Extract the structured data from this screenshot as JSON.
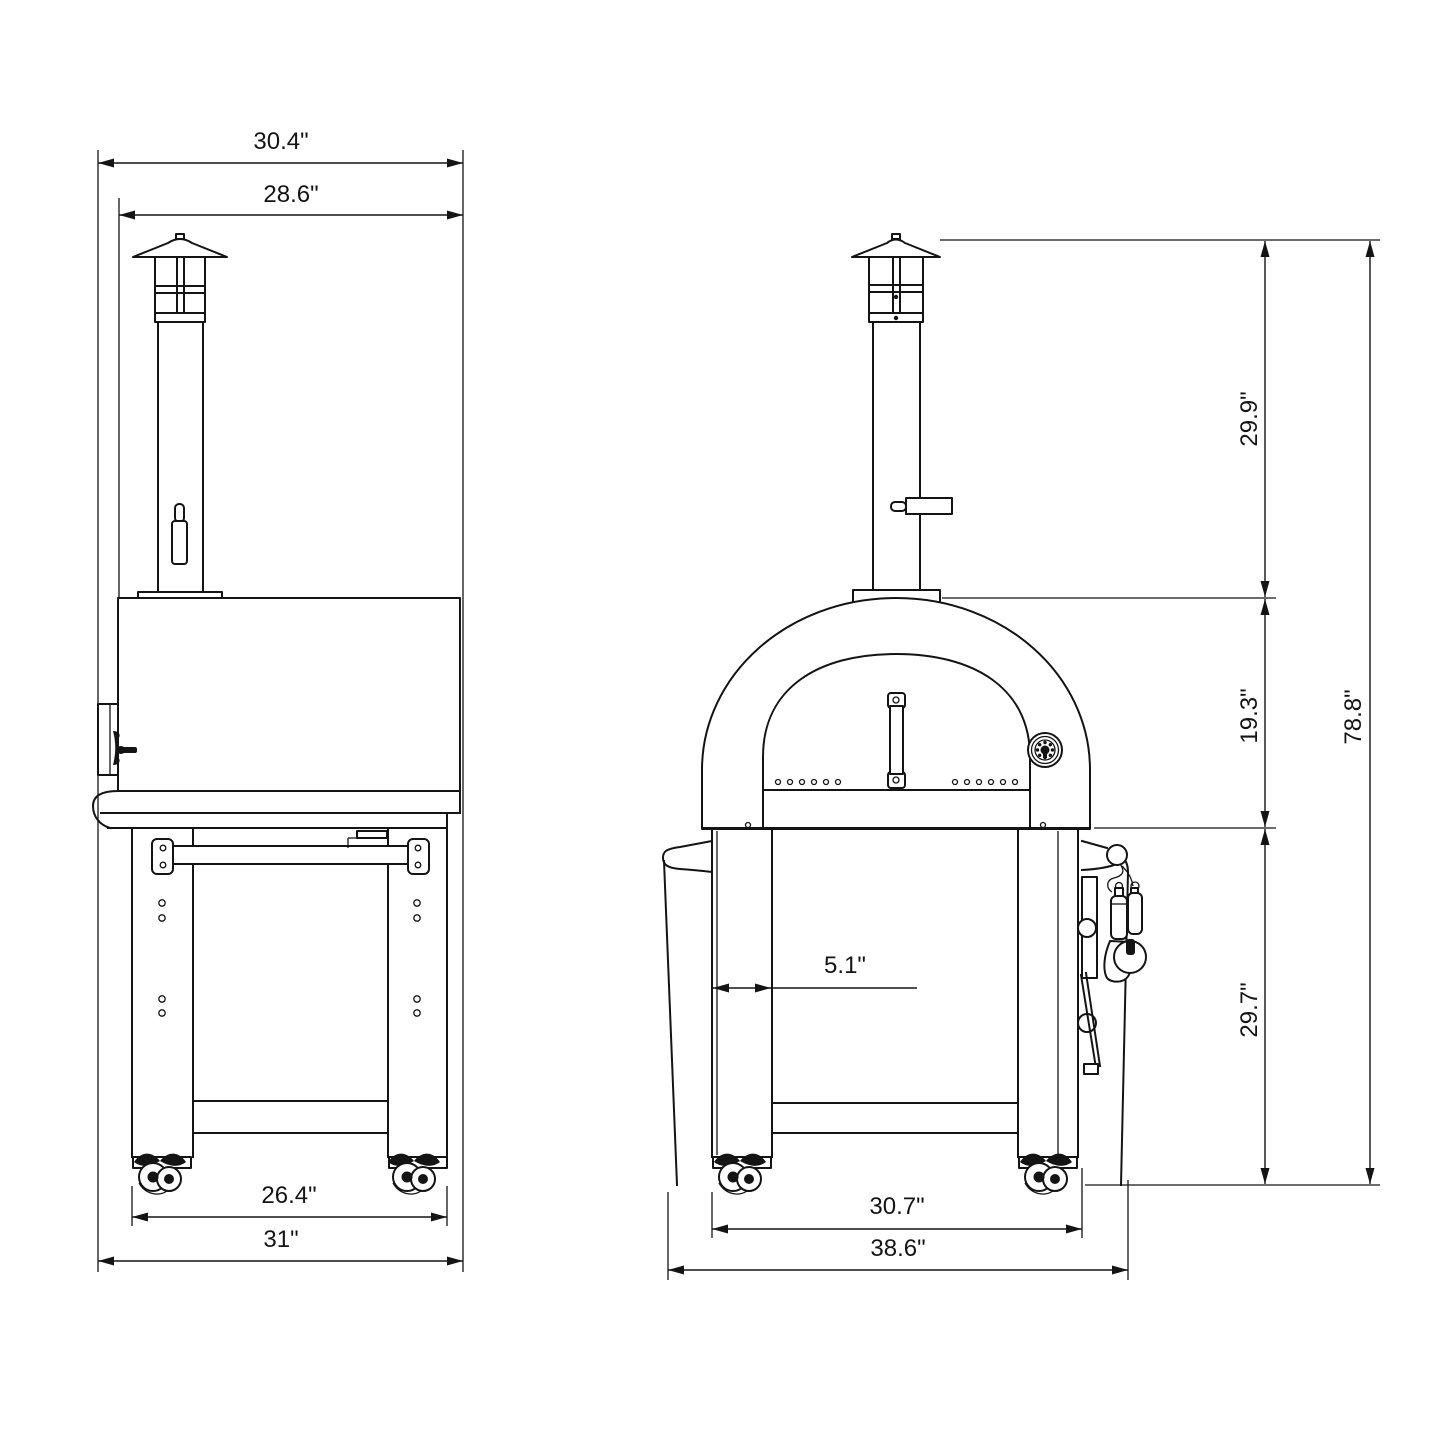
{
  "drawing": {
    "type": "technical dimension drawing",
    "subject": "outdoor pizza oven with chimney and rolling stand, two orthographic views",
    "line_color": "#141414",
    "background_color": "#ffffff",
    "views": {
      "side": {
        "name": "side view",
        "dims": {
          "overall_depth": "30.4\"",
          "hood_depth": "28.6\"",
          "caster_span_depth": "26.4\"",
          "base_depth": "31\""
        }
      },
      "front": {
        "name": "front view",
        "dims": {
          "chimney_height": "29.9\"",
          "dome_height": "19.3\"",
          "leg_width": "5.1\"",
          "stand_height": "29.7\"",
          "overall_height": "78.8\"",
          "caster_span_width": "30.7\"",
          "overall_width": "38.6\""
        }
      }
    }
  }
}
